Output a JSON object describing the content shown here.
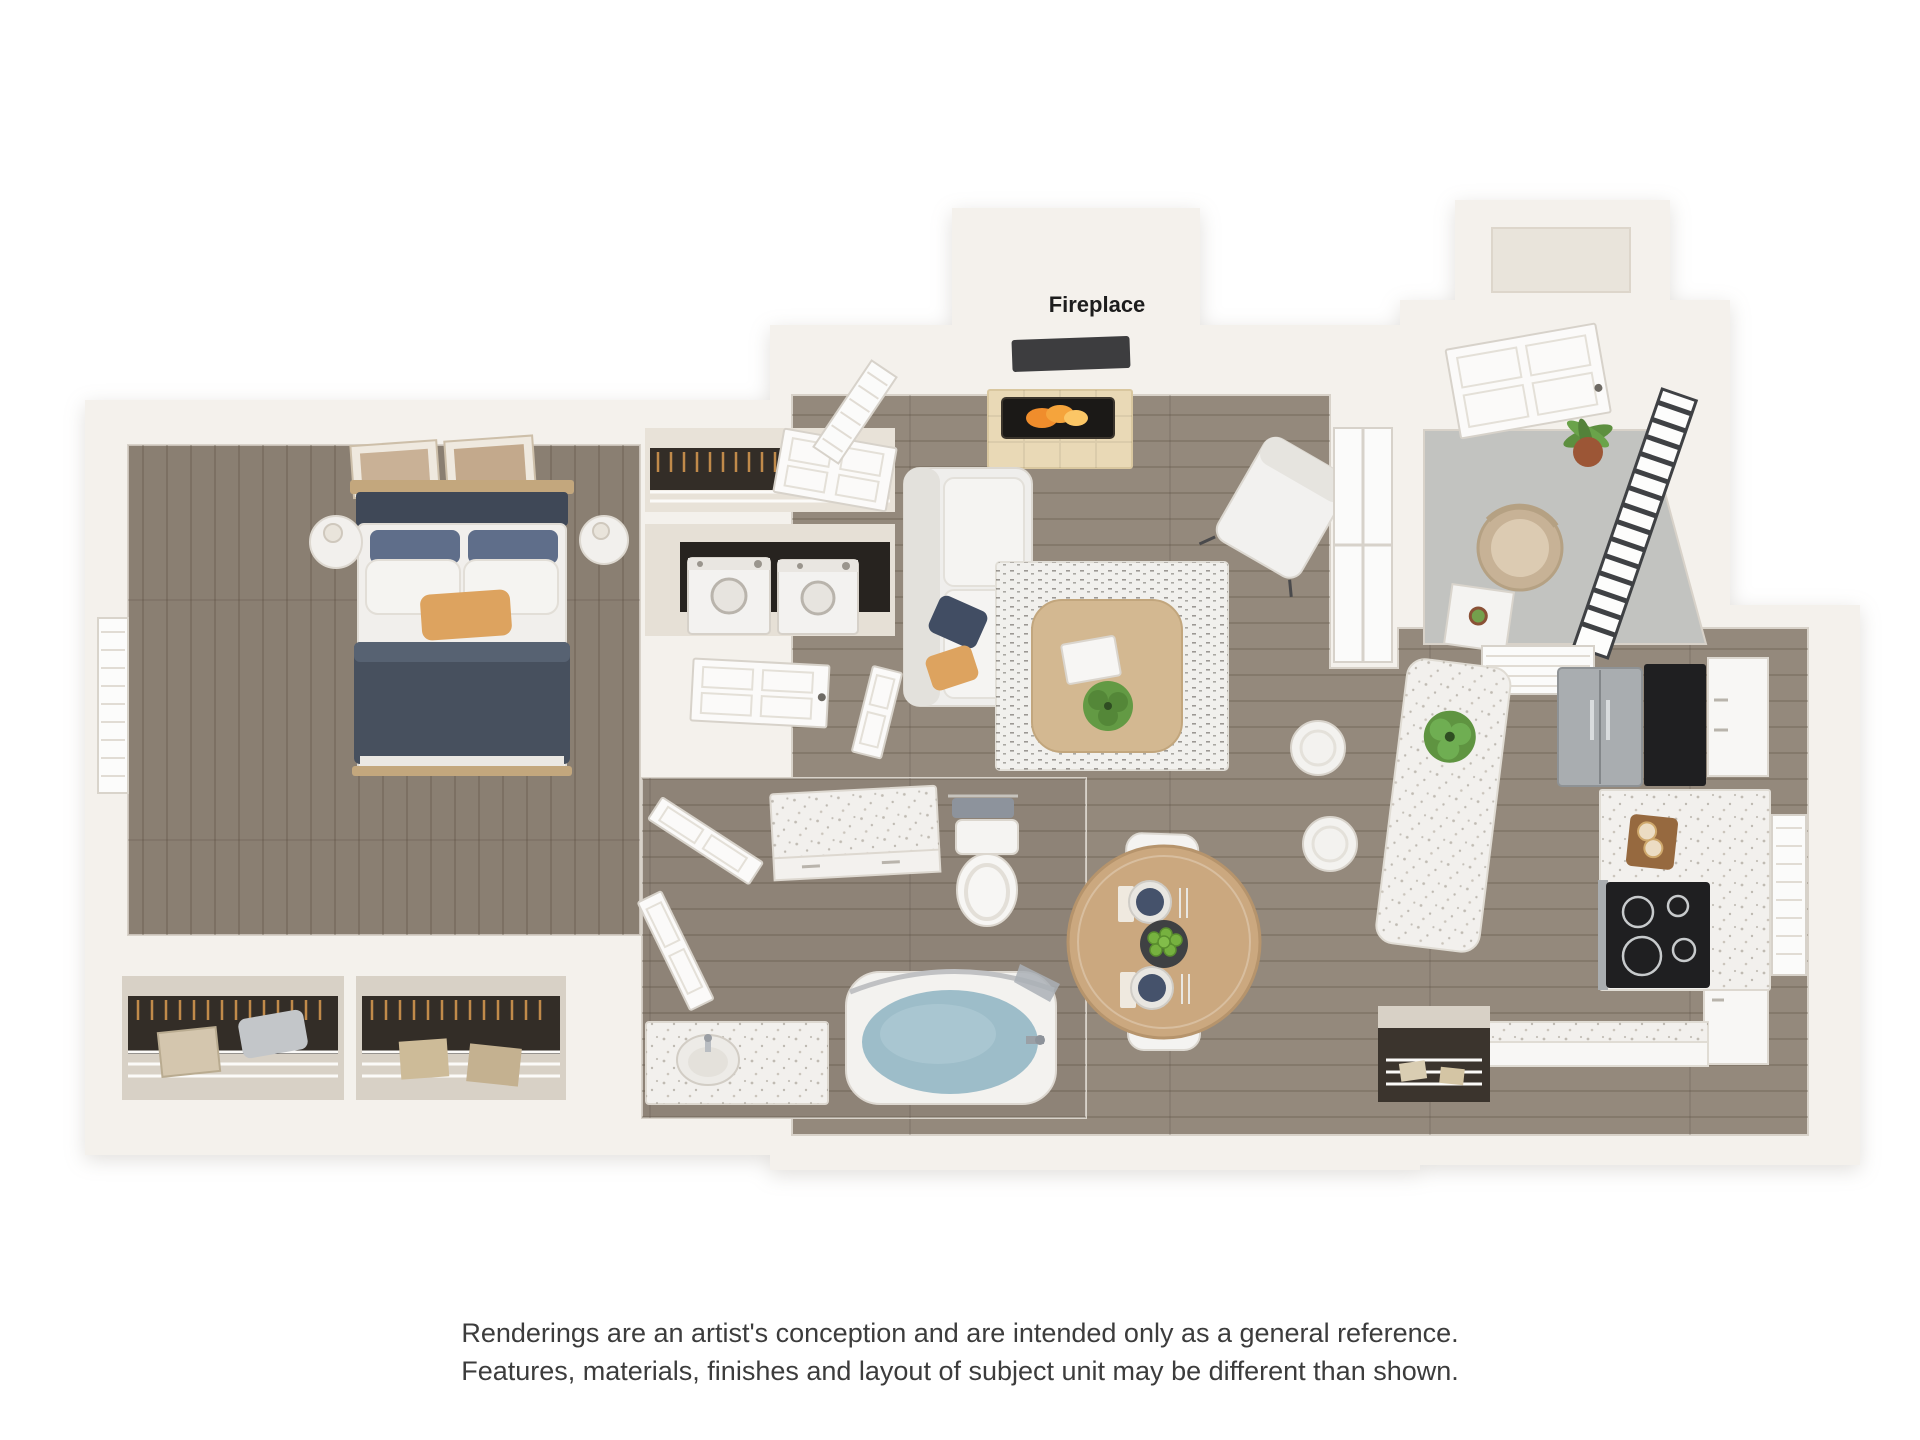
{
  "floor_plan": {
    "fireplace_label": "Fireplace"
  },
  "disclaimer": {
    "line1": "Renderings are an artist's conception and are intended only as a general reference.",
    "line2": "Features, materials, finishes and layout of subject unit may be different than shown."
  },
  "colors": {
    "background": "#ffffff",
    "wall": "#f4f1ec",
    "wall_inner": "#e9e4db",
    "wood_floor": "#94897c",
    "wood_floor_dark": "#84796d",
    "balcony_floor": "#c2c3c0",
    "railing": "#3f4144",
    "closet_dark": "#332d27",
    "counter": "#f2f0ed",
    "appliance_steel": "#a9adb0",
    "appliance_black": "#1f1f21",
    "bed_duvet": "#47505e",
    "pillow_accent": "#dda35f",
    "pillow_pattern": "#5f6e8a",
    "sofa": "#efeeec",
    "rug": "#f1f0ed",
    "coffee_table": "#d3b891",
    "dining_table": "#cba87f",
    "plate": "#45526b",
    "greenery": "#5f9441",
    "terracotta": "#9c5636",
    "tub_water": "#9dbdc9",
    "fire": "#f08d2c",
    "hearth": "#e9d9b6",
    "wicker": "#c7b296",
    "text_dark": "#1d1d1d",
    "text_gray": "#3c3c3c"
  }
}
